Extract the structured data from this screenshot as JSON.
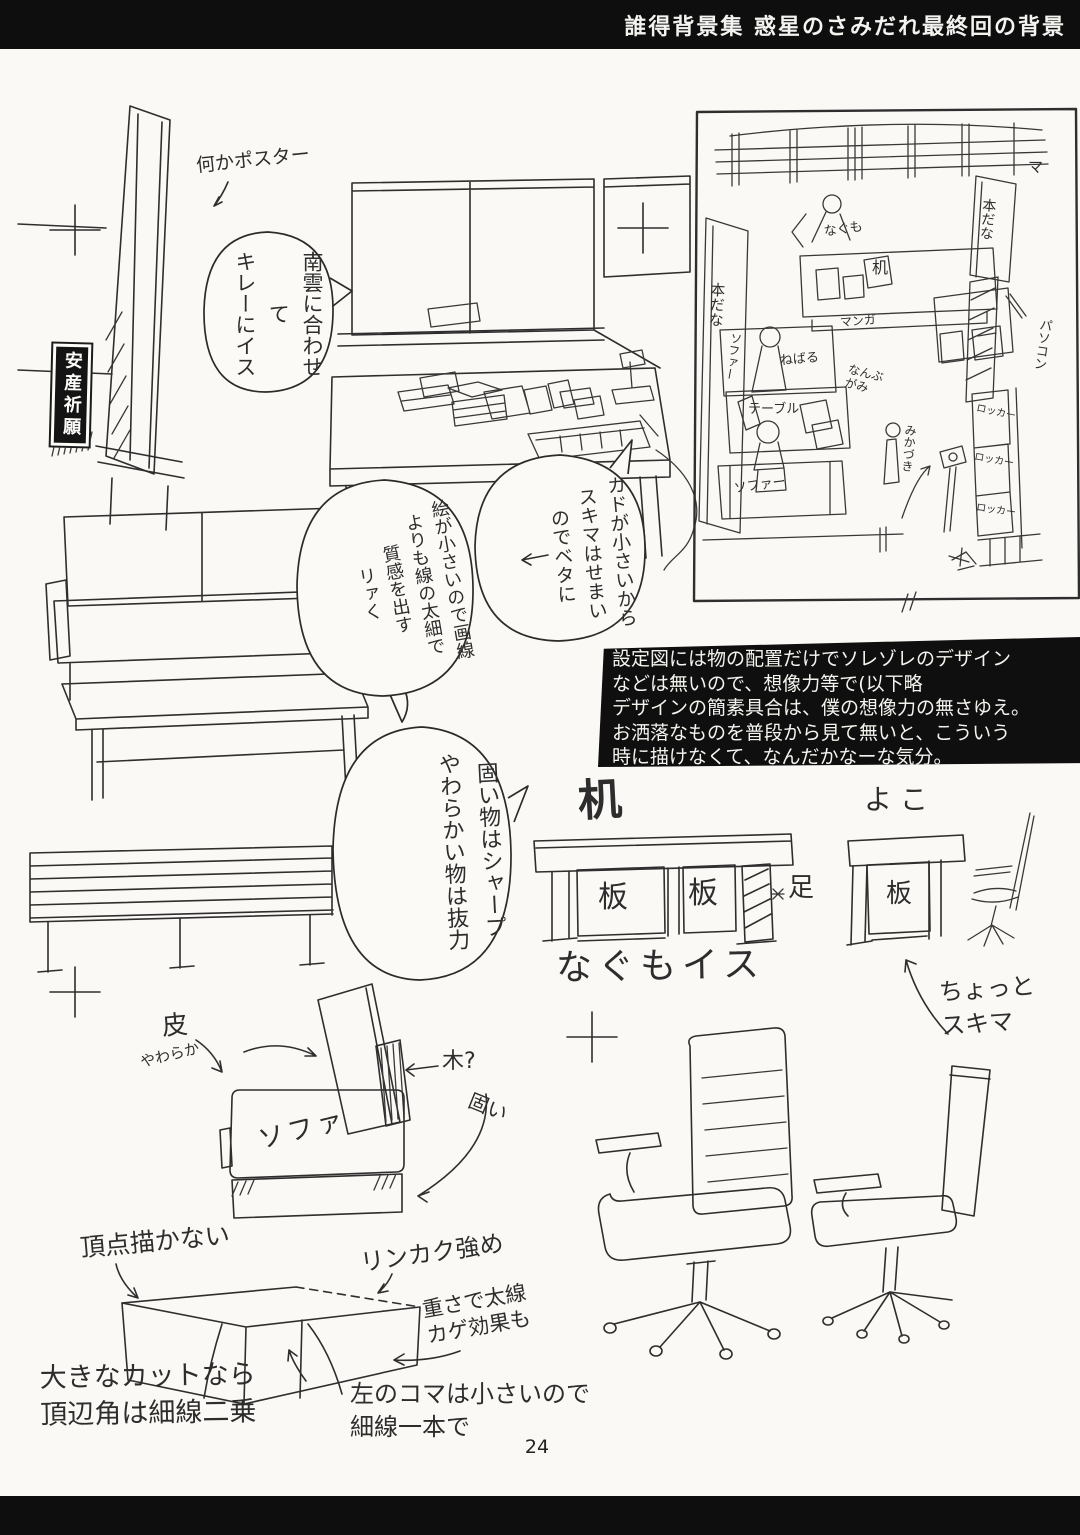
{
  "header": {
    "title": "誰得背景集 惑星のさみだれ最終回の背景"
  },
  "footer": {
    "page_number": "24"
  },
  "annotations": {
    "poster_note": "何かポスター",
    "poster_sign": "安産祈願",
    "bubble_tv": "南雲に合わせて\nキレーにイス",
    "bubble_lines": "絵が小さいので画線\nよりも線の太細で\n質感を出す\nリァく",
    "bubble_beta": "カドが小さいから\nスキマはせまい\nのでベタに",
    "bubble_hard_soft": "固い物はシャープ\nやわらかい物は抜力",
    "note_box": "設定図には物の配置だけでソレゾレのデザイン\nなどは無いので、想像力等で(以下略\nデザインの簡素具合は、僕の想像力の無さゆえ。\nお洒落なものを普段から見て無いと、こういう\n時に描けなくて、なんだかなーな気分。"
  },
  "floor_plan": {
    "window_mark": "マ",
    "bookshelf_left": "本だな",
    "bookshelf_right": "本だな",
    "nagumo": "なぐも",
    "desk": "机",
    "manga": "マンガ",
    "sofa_top": "ソファー",
    "nebaru": "ねばる",
    "table": "テーブル",
    "sofa_bottom": "ソファー",
    "nanbugami": "なんぶ\nがみ",
    "mikazuki": "みかづき",
    "locker1": "ロッカー",
    "locker2": "ロッカー",
    "locker3": "ロッカー",
    "pc": "パソコン"
  },
  "desk_diagram": {
    "title": "机",
    "board_left": "板",
    "board_right": "板",
    "leg": "足",
    "caption": "なぐもイス"
  },
  "side_diagram": {
    "title": "よこ",
    "board": "板",
    "gap_note": "ちょっと\nスキマ"
  },
  "sofa_diagram": {
    "leather": "皮",
    "soft": "やわらか",
    "wood": "木?",
    "hard": "固い",
    "label": "ソファ"
  },
  "box_diagram": {
    "no_vertex": "頂点描かない",
    "outline": "リンカク強め",
    "big_cut": "大きなカットなら\n頂辺角は細線二乗",
    "small_panel": "左のコマは小さいので\n細線一本で",
    "weight": "重さで太線\nカゲ効果も"
  }
}
